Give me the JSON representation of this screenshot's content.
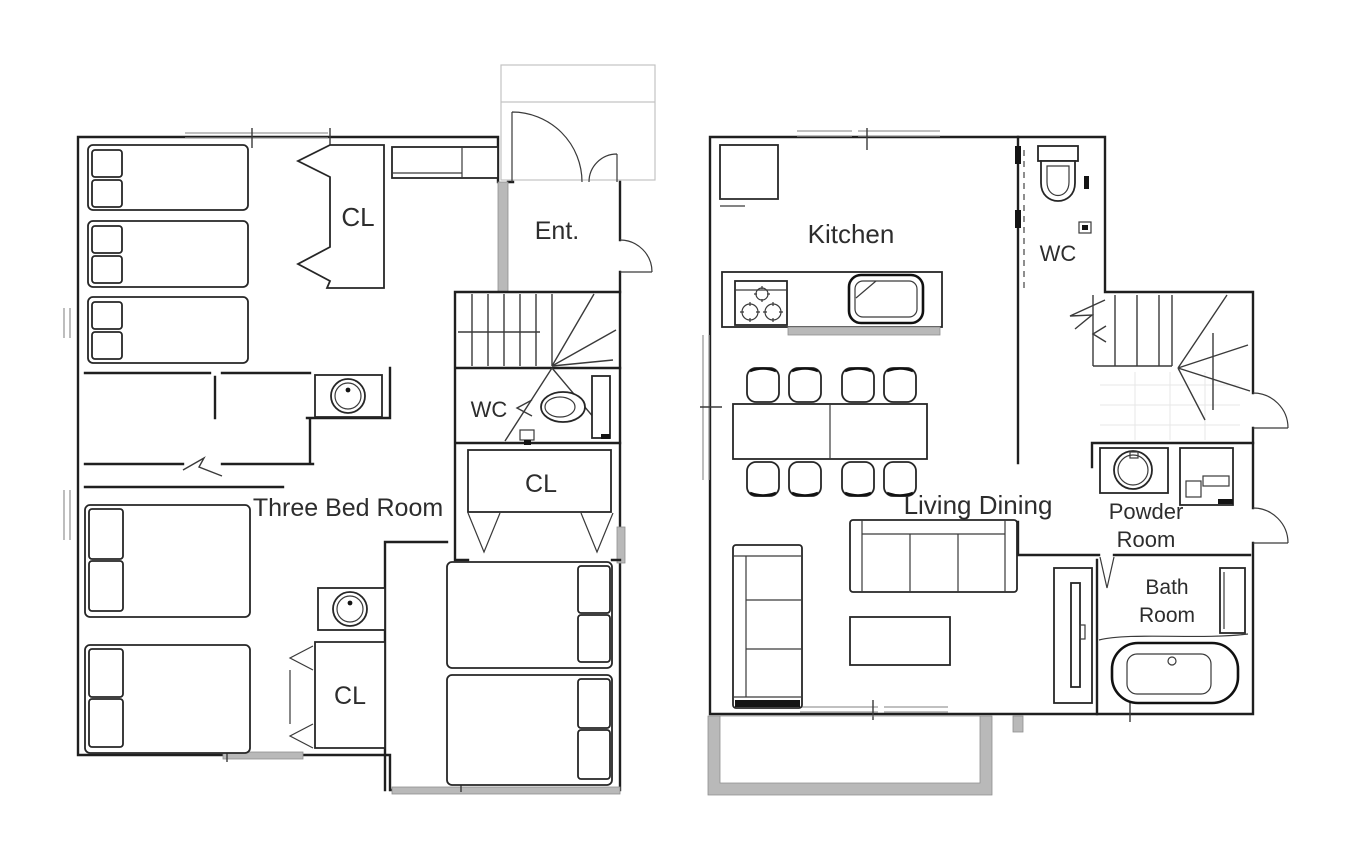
{
  "document": {
    "type": "floor-plan",
    "description": "Two-storey house floor plans side by side"
  },
  "colors": {
    "background": "#ffffff",
    "wall_line": "#1f1f1f",
    "furniture_line": "#262626",
    "wall_fill_gray": "#b9b9b9",
    "porch_line_gray": "#c3c3c3",
    "text": "#2d2d2d"
  },
  "floor_left": {
    "rooms": {
      "closet_top": "CL",
      "entrance": "Ent.",
      "wc": "WC",
      "closet_middle": "CL",
      "bedroom": "Three Bed Room",
      "closet_bottom": "CL"
    }
  },
  "floor_right": {
    "rooms": {
      "kitchen": "Kitchen",
      "wc": "WC",
      "living_dining": "Living Dining",
      "powder_line1": "Powder",
      "powder_line2": "Room",
      "bath_line1": "Bath",
      "bath_line2": "Room"
    }
  }
}
